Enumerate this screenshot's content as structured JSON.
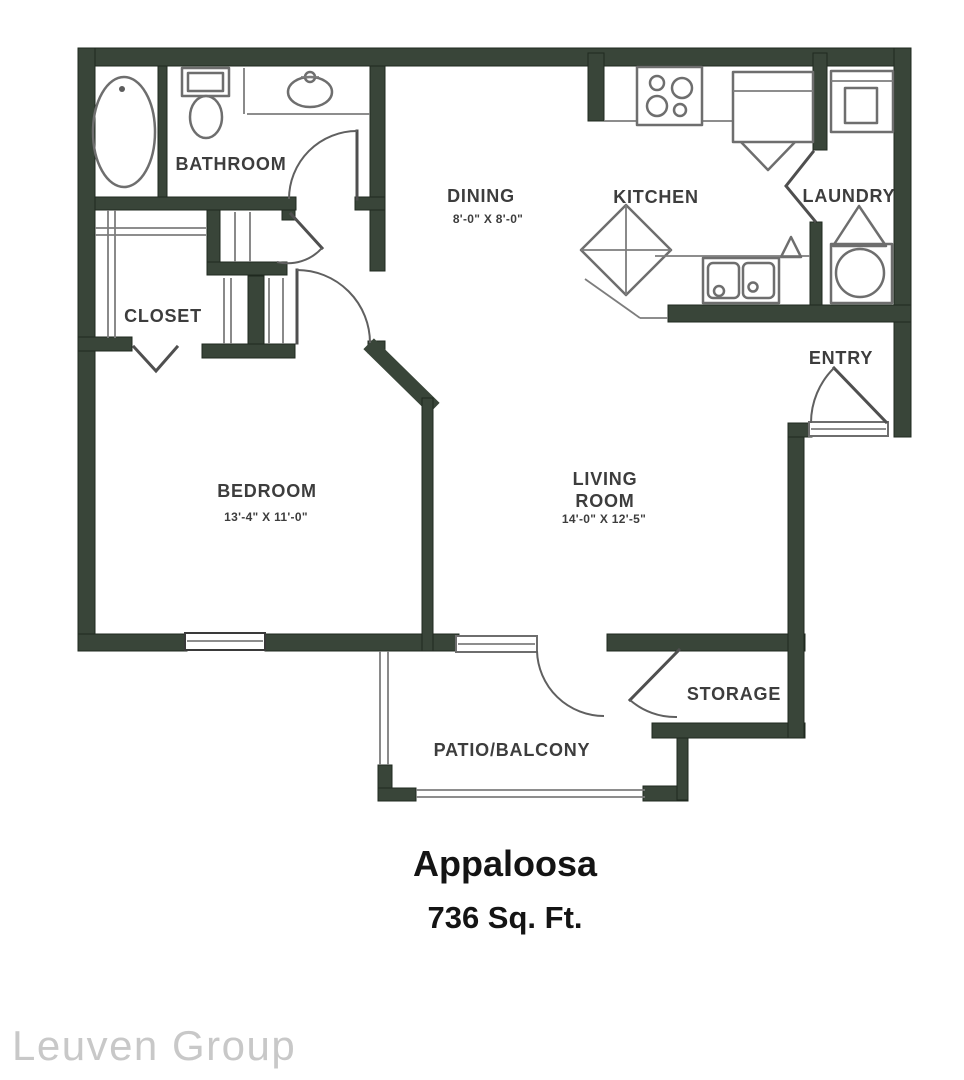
{
  "title": {
    "name": "Appaloosa",
    "area": "736 Sq. Ft."
  },
  "watermark": "Leuven Group",
  "rooms": {
    "bathroom": {
      "label": "BATHROOM"
    },
    "closet": {
      "label": "CLOSET"
    },
    "dining": {
      "label": "DINING",
      "dims": "8'-0\" X 8'-0\""
    },
    "kitchen": {
      "label": "KITCHEN"
    },
    "laundry": {
      "label": "LAUNDRY"
    },
    "entry": {
      "label": "ENTRY"
    },
    "bedroom": {
      "label": "BEDROOM",
      "dims": "13'-4\" X 11'-0\""
    },
    "living": {
      "label1": "LIVING",
      "label2": "ROOM",
      "dims": "14'-0\" X 12'-5\""
    },
    "storage": {
      "label": "STORAGE"
    },
    "patio": {
      "label": "PATIO/BALCONY"
    }
  },
  "colors": {
    "wall": "#394539",
    "fixture_line": "#6e6e6e",
    "door_line": "#4f4f4f",
    "label_text": "#3d3d3d",
    "title_text": "#141414",
    "watermark_text": "#c8c8c8"
  }
}
